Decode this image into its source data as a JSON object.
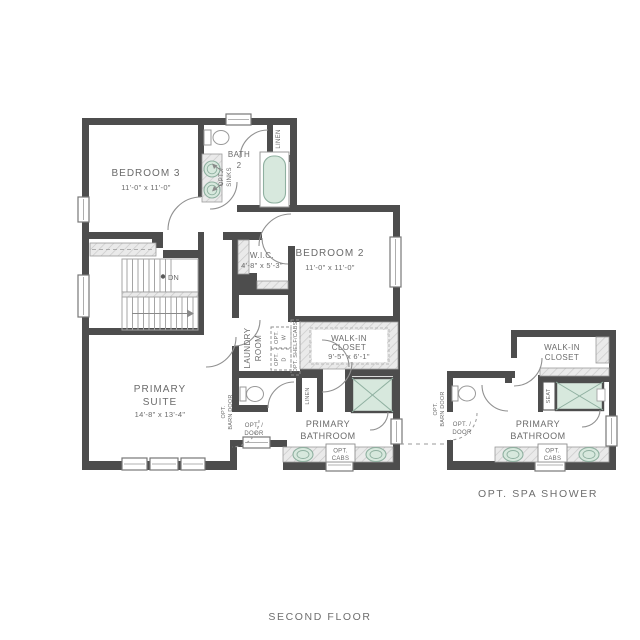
{
  "captions": {
    "option": "OPT. SPA SHOWER",
    "floor": "SECOND FLOOR"
  },
  "rooms": {
    "bedroom3": {
      "name": "BEDROOM 3",
      "dims": "11'-0\" x 11'-0\""
    },
    "bath2_l1": "BATH",
    "bath2_l2": "2",
    "bedroom2": {
      "name": "BEDROOM 2",
      "dims": "11'-0\" x 11'-0\""
    },
    "wic": {
      "name": "W.I.C.",
      "dims": "4'-8\" x 5'-3\""
    },
    "primary_suite": {
      "l1": "PRIMARY",
      "l2": "SUITE",
      "dims": "14'-8\" x 13'-4\""
    },
    "laundry": {
      "l1": "LAUNDRY",
      "l2": "ROOM"
    },
    "walkin": {
      "l1": "WALK-IN",
      "l2": "CLOSET",
      "dims": "9'-5\" x 6'-1\""
    },
    "primary_bath": {
      "l1": "PRIMARY",
      "l2": "BATHROOM"
    }
  },
  "labels": {
    "linen": "LINEN",
    "dn": "DN",
    "seat": "SEAT",
    "opt": "OPT.",
    "w": "W",
    "d": "D",
    "barn_door": "BARN DOOR",
    "opt_slash": "OPT. /",
    "door": "DOOR",
    "sinks": "SINKS",
    "cabs": "CABS",
    "shelf_cabs": "OPT. SHELF/CABS"
  },
  "colors": {
    "wall": "#4d4d4d",
    "text": "#6b6b6b",
    "fixture_fill": "#d7e8dd",
    "fixture_stroke": "#8fb0a0"
  }
}
